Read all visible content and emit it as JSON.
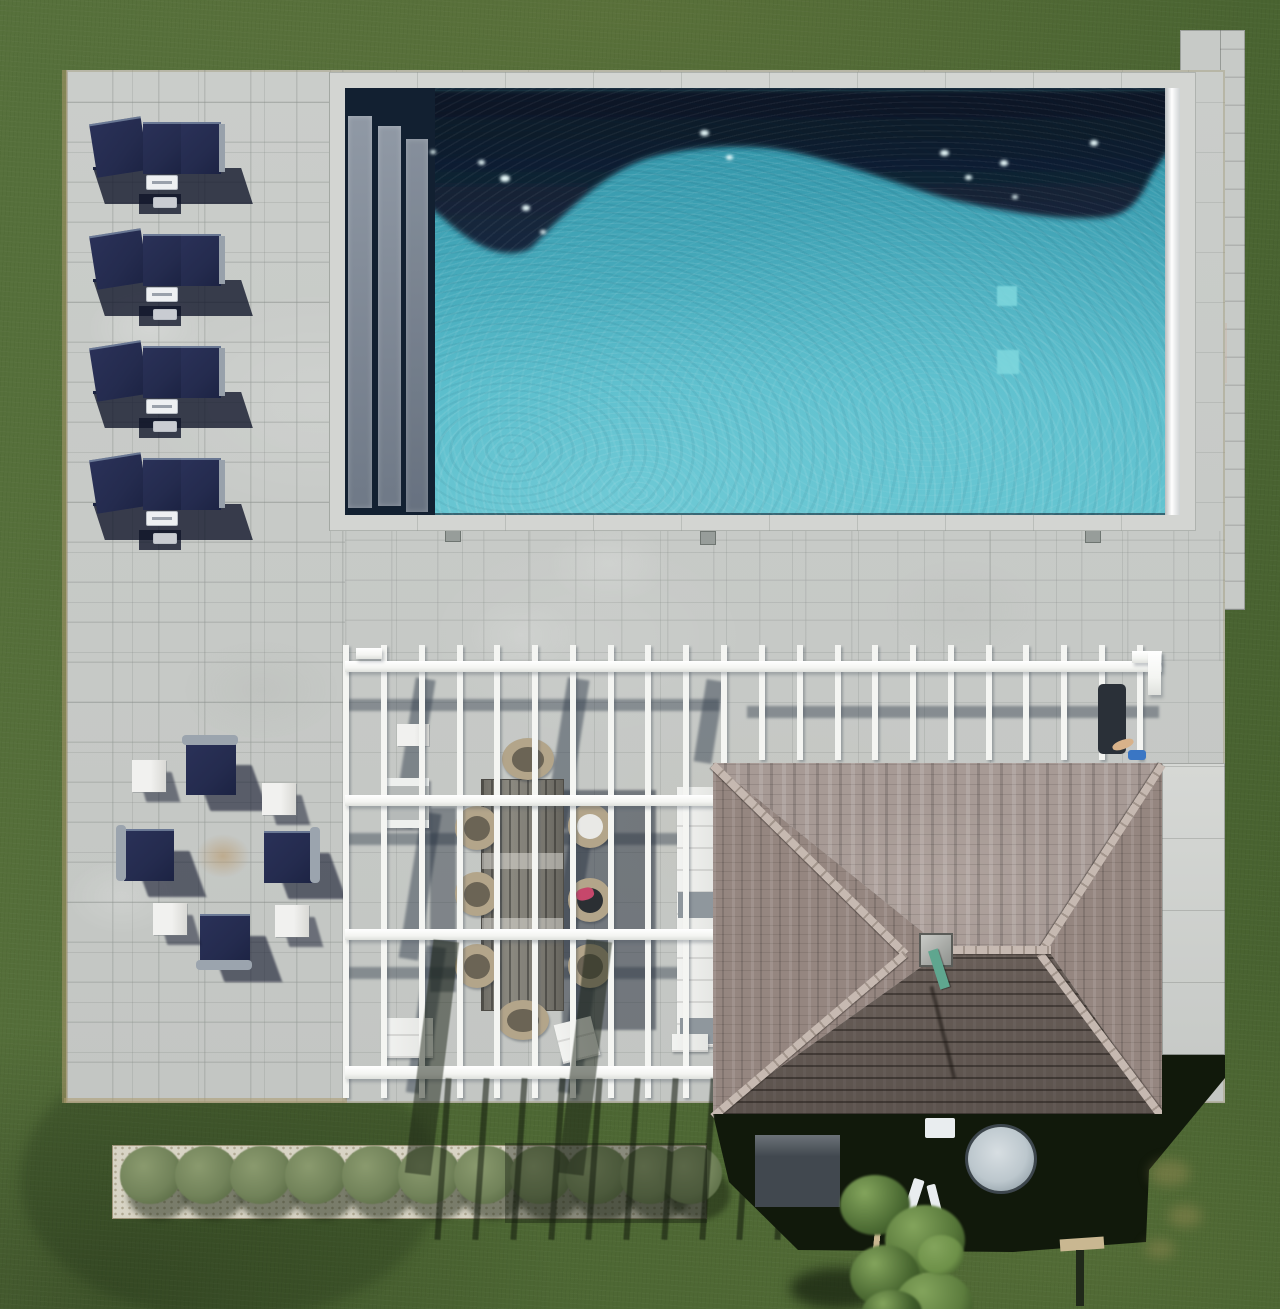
{
  "meta": {
    "type": "aerial-drone-photograph",
    "alt": "Overhead drone view of a backyard: rectangular pool with dark deep end and turquoise shallow end, stone patio with four navy chaise lounges, navy lounge-chair fire-pit seating group, white slatted pergola over an outdoor dining table, gray-shingled hip-roof pool house casting a long shadow, gravel planting bed with shrubs, surrounded by lawn."
  },
  "palette": {
    "grass-1": "#57713c",
    "grass-2": "#4e6834",
    "grass-3": "#486230",
    "grass-dark": "#1a2610",
    "grass-light": "#7d9454",
    "patio": "#c7cac7",
    "patio-light": "#d6d8d5",
    "coping": "#d3d5d2",
    "edging": "#ac9a6d",
    "pool-dark": "#0e1c2f",
    "pool-teal": "#3395a9",
    "pool-teal-2": "#55bac9",
    "pool-light": "#7fd8de",
    "roller": "#eceeef",
    "navy": "#242b4e",
    "white": "#f4f5f2",
    "wicker": "#b3a58a",
    "wicker-dark": "#6b6455",
    "roof-top": "#a79a95",
    "roof-side": "#958680",
    "roof-front": "#7a6e67",
    "roof-cap": "#c6b9b1",
    "verdigris": "#5fa68f",
    "house-shadow": "#11190b",
    "equip-box": "#41484f",
    "equip-drum": "#bcc7cd",
    "pipe": "#e9edef",
    "gravel": "#d8d4c5",
    "shrub": "#72835a",
    "shrub-dark": "#4d5f3a",
    "fence": "#c9b791",
    "firepit": "#bfa988",
    "pink": "#c6476b"
  },
  "structures": {
    "lounges": {
      "x": 93,
      "ys": [
        118,
        230,
        342,
        454
      ]
    },
    "fire_chairs": [
      {
        "x": 180,
        "y": 737,
        "back": "top"
      },
      {
        "x": 118,
        "y": 823,
        "back": "left"
      },
      {
        "x": 258,
        "y": 825,
        "back": "right"
      },
      {
        "x": 194,
        "y": 908,
        "back": "bottom"
      }
    ],
    "fire_cubes": [
      [
        132,
        760
      ],
      [
        262,
        783
      ],
      [
        153,
        903
      ],
      [
        275,
        905
      ]
    ],
    "firepit_center": {
      "x": 196,
      "y": 834,
      "w": 54,
      "h": 44
    },
    "pergola": {
      "long_slats": {
        "xs": [
          343,
          381,
          419,
          457,
          494,
          532,
          570,
          608,
          645,
          683,
          721
        ],
        "y1": 645,
        "y2": 1098
      },
      "short_slats": {
        "xs": [
          759,
          797,
          835,
          872,
          910,
          948,
          986,
          1023,
          1061,
          1099,
          1137
        ],
        "y1": 645,
        "y2": 760
      },
      "beams": [
        [
          345,
          661,
          817,
          11
        ],
        [
          345,
          795,
          374,
          11
        ],
        [
          345,
          929,
          374,
          11
        ],
        [
          345,
          1066,
          374,
          13
        ]
      ],
      "beam_shadows": [
        [
          345,
          699,
          374,
          12
        ],
        [
          345,
          833,
          374,
          12
        ],
        [
          345,
          967,
          374,
          12
        ],
        [
          747,
          706,
          412,
          12
        ]
      ],
      "diag_bands": [
        [
          404,
          678,
          20,
          150,
          9
        ],
        [
          556,
          678,
          22,
          150,
          9
        ],
        [
          700,
          680,
          18,
          83,
          9
        ],
        [
          410,
          812,
          20,
          148,
          9
        ],
        [
          562,
          812,
          22,
          148,
          9
        ],
        [
          416,
          946,
          20,
          148,
          8
        ],
        [
          568,
          946,
          22,
          148,
          8
        ]
      ],
      "thick_stripes": [
        [
          419,
          940,
          26,
          235,
          7
        ],
        [
          572,
          940,
          26,
          235,
          7
        ]
      ],
      "thin_stripe_offset": 97,
      "thin_stripe_span": [
        1078,
        1240
      ]
    },
    "dining_chairs": [
      {
        "x": 502,
        "y": 738,
        "w": 52,
        "h": 42,
        "seat": "dark"
      },
      {
        "x": 455,
        "y": 806,
        "w": 44,
        "h": 44,
        "seat": "dark"
      },
      {
        "x": 455,
        "y": 872,
        "w": 44,
        "h": 44,
        "seat": "dark"
      },
      {
        "x": 455,
        "y": 944,
        "w": 44,
        "h": 44,
        "seat": "dark"
      },
      {
        "x": 568,
        "y": 804,
        "w": 44,
        "h": 44,
        "seat": "white"
      },
      {
        "x": 568,
        "y": 878,
        "w": 44,
        "h": 44,
        "seat": "pink"
      },
      {
        "x": 568,
        "y": 944,
        "w": 44,
        "h": 44,
        "seat": "dark"
      },
      {
        "x": 497,
        "y": 1000,
        "w": 52,
        "h": 40,
        "seat": "dark"
      }
    ],
    "table_bands": [
      73,
      138
    ],
    "sparkles": [
      [
        500,
        175,
        10
      ],
      [
        522,
        205,
        8
      ],
      [
        478,
        160,
        7
      ],
      [
        540,
        230,
        6
      ],
      [
        700,
        130,
        9
      ],
      [
        726,
        155,
        7
      ],
      [
        940,
        150,
        9
      ],
      [
        965,
        175,
        7
      ],
      [
        1000,
        160,
        8
      ],
      [
        1012,
        195,
        6
      ],
      [
        1090,
        140,
        8
      ],
      [
        430,
        150,
        6
      ]
    ],
    "pool_drains": [
      [
        997,
        286,
        20,
        20
      ],
      [
        997,
        350,
        22,
        24
      ]
    ],
    "patio_drains": [
      [
        445,
        528
      ],
      [
        700,
        531
      ],
      [
        1085,
        529
      ]
    ],
    "shrubs": {
      "xs": [
        150,
        205,
        260,
        315,
        372,
        428,
        484,
        540,
        596,
        650,
        690
      ],
      "y": 1178
    },
    "roof_caps": [
      {
        "x": 0,
        "y": -2,
        "len": 270,
        "rot": 44.5
      },
      {
        "x": 449,
        "y": -2,
        "len": 225,
        "rot": 122.9
      },
      {
        "x": 0,
        "y": 350,
        "len": 252,
        "rot": -40.3
      },
      {
        "x": 449,
        "y": 350,
        "len": 204,
        "rot": -126.8
      },
      {
        "x": 228,
        "y": 183,
        "len": 110,
        "rot": 0
      }
    ],
    "tree_blobs": [
      [
        840,
        1175,
        70,
        60,
        "#4c6b33"
      ],
      [
        885,
        1205,
        80,
        70,
        "#557538"
      ],
      [
        850,
        1245,
        70,
        62,
        "#47652f"
      ],
      [
        895,
        1272,
        78,
        64,
        "#5d7d3e"
      ],
      [
        862,
        1290,
        60,
        45,
        "#3f5c2a"
      ],
      [
        918,
        1235,
        46,
        40,
        "#6d9048"
      ]
    ],
    "dry_patches": [
      [
        1150,
        1160,
        40,
        26
      ],
      [
        1168,
        1205,
        34,
        22
      ],
      [
        1145,
        1240,
        30,
        18
      ]
    ]
  }
}
